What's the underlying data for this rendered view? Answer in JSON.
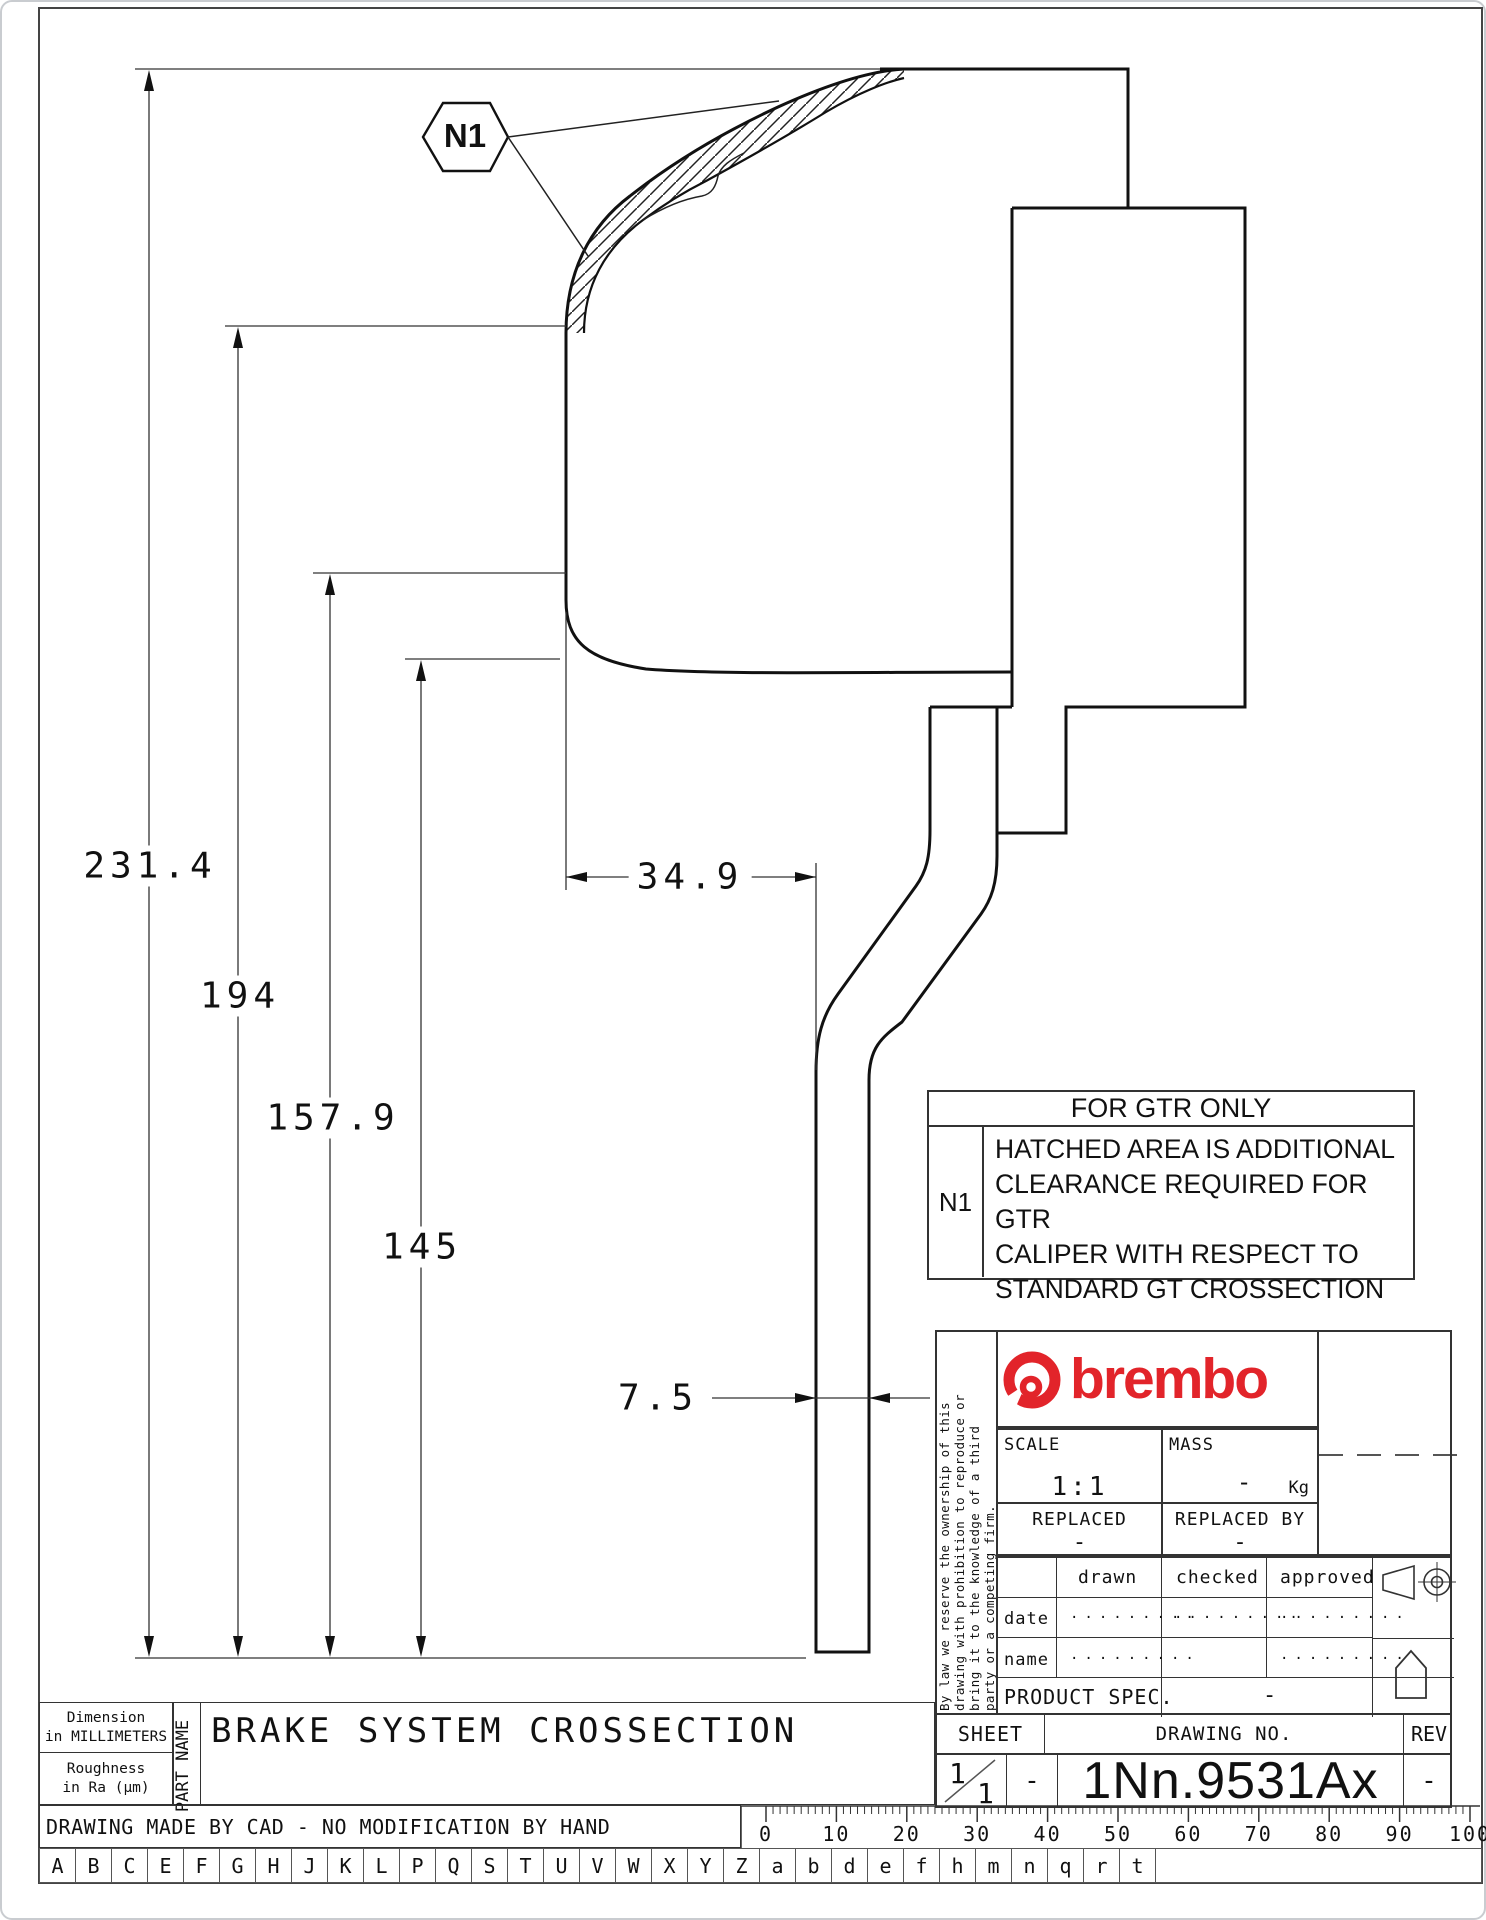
{
  "accent_red": "#e2242a",
  "drawing": {
    "callout_label": "N1",
    "dims": {
      "overall": "231.4",
      "h194": "194",
      "h1579": "157.9",
      "h145": "145",
      "w349": "34.9",
      "t75": "7.5"
    }
  },
  "gtr": {
    "title": "FOR GTR ONLY",
    "ref": "N1",
    "note_lines": [
      "HATCHED AREA IS ADDITIONAL",
      "CLEARANCE REQUIRED FOR GTR",
      "CALIPER WITH RESPECT TO",
      "STANDARD GT CROSSECTION"
    ]
  },
  "legal": {
    "lines": [
      "By law we reserve the ownership of this",
      "drawing with prohibition to reproduce or",
      "bring it to the knowledge of a third",
      "party or a competing firm."
    ]
  },
  "title_block": {
    "brand": "brembo",
    "scale_label": "SCALE",
    "scale_value": "1:1",
    "mass_label": "MASS",
    "mass_value": "-",
    "mass_unit": "Kg",
    "replaced_label": "REPLACED",
    "replaced_value": "-",
    "replaced_by_label": "REPLACED BY",
    "replaced_by_value": "-",
    "col_drawn": "drawn",
    "col_checked": "checked",
    "col_approved": "approved",
    "row_date": "date",
    "row_name": "name",
    "dots": ".........",
    "product_spec_label": "PRODUCT SPEC.",
    "product_spec_value": "-",
    "sheet_label": "SHEET",
    "drawing_no_label": "DRAWING NO.",
    "rev_label": "REV",
    "sheet_top": "1",
    "sheet_bottom": "1",
    "sheet_dash": "-",
    "drawing_no": "1Nn.9531Ax",
    "rev_value": "-"
  },
  "footer": {
    "dim_note_l1": "Dimension",
    "dim_note_l2": "in MILLIMETERS",
    "rough_l1": "Roughness",
    "rough_l2": "in Ra (μm)",
    "part_name_label": "PART NAME",
    "part_title": "BRAKE SYSTEM CROSSECTION",
    "cad_note": "DRAWING MADE BY CAD - NO MODIFICATION BY HAND",
    "ruler_numbers": [
      "0",
      "10",
      "20",
      "30",
      "40",
      "50",
      "60",
      "70",
      "80",
      "90",
      "100"
    ],
    "alphabet": [
      "A",
      "B",
      "C",
      "E",
      "F",
      "G",
      "H",
      "J",
      "K",
      "L",
      "P",
      "Q",
      "S",
      "T",
      "U",
      "V",
      "W",
      "X",
      "Y",
      "Z",
      "a",
      "b",
      "d",
      "e",
      "f",
      "h",
      "m",
      "n",
      "q",
      "r",
      "t"
    ]
  }
}
